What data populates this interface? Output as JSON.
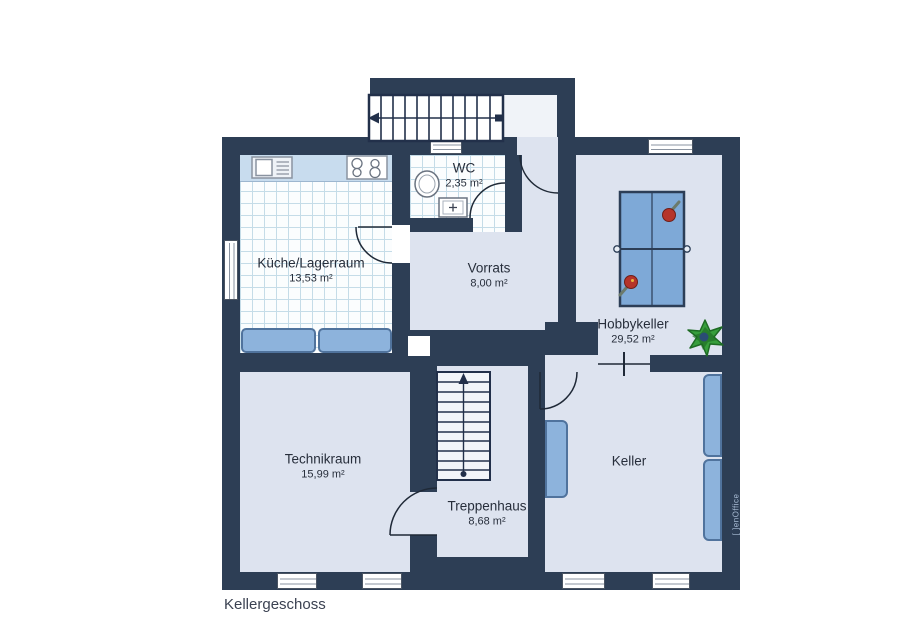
{
  "title": "Kellergeschoss",
  "watermark": "[ ]enOffice",
  "rooms": {
    "kueche": {
      "name": "Küche/Lagerraum",
      "area": "13,53 m²"
    },
    "wc": {
      "name": "WC",
      "area": "2,35 m²"
    },
    "vorrats": {
      "name": "Vorrats",
      "area": "8,00 m²"
    },
    "hobbykeller": {
      "name": "Hobbykeller",
      "area": "29,52 m²"
    },
    "technikraum": {
      "name": "Technikraum",
      "area": "15,99 m²"
    },
    "treppenhaus": {
      "name": "Treppenhaus",
      "area": "8,68 m²"
    },
    "keller": {
      "name": "Keller"
    }
  },
  "colors": {
    "wall": "#2d3e55",
    "floor": "#dde3ef",
    "tile_line": "#c5dce8",
    "furniture_blue": "#8db3dc",
    "table_tennis_blue": "#7ea9d7",
    "paddle_red": "#b5342a",
    "plant_green": "#379e3c",
    "label_text": "#272e3b"
  }
}
